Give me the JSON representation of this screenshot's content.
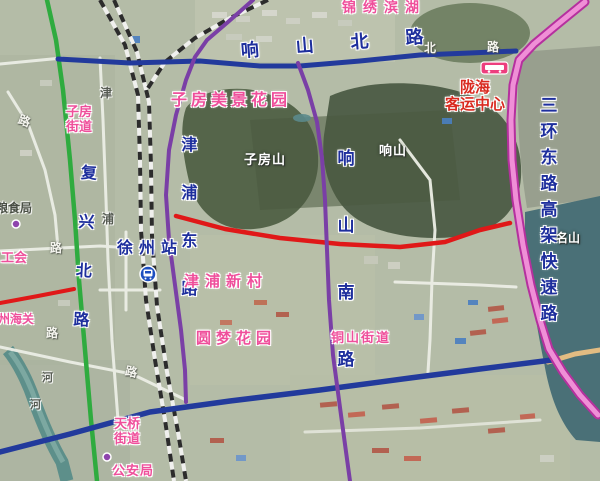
{
  "map": {
    "road_labels": {
      "xiangshan_north": "响山北路",
      "jinpu_east": "津浦东路",
      "xiangshan_south": "响山南路",
      "fuxing_north": "复兴北路",
      "third_ring_expressway": "三环东路高架快速路"
    },
    "stations": {
      "railway_station": "徐州站",
      "bus_terminal": "陇海\n客运中心"
    },
    "places": {
      "jinxiu_binhu": "锦绣滨湖",
      "zifang_scenic_garden": "子房美景花园",
      "zifang_subdistrict": "子房\n街道",
      "jinpu_xincun": "津浦新村",
      "yuanmeng_garden": "圆梦花园",
      "tongshan_subdistrict": "铜山街道",
      "tianqiao_subdistrict": "天桥\n街道",
      "public_security_bureau": "公安局",
      "labor_union": "工会",
      "customs": "州海关",
      "grain_bureau": "粮食局"
    },
    "mountains": {
      "zifangshan": "子房山",
      "xiangshan": "响山",
      "mingshan": "名山"
    },
    "fragments": {
      "jin": "津",
      "pu": "浦",
      "he1": "河",
      "he2": "河",
      "lu1": "路",
      "lu2": "路",
      "lu3": "路",
      "lu4": "路",
      "bei_w": "北",
      "lu_w": "路"
    },
    "icons": {
      "bus_badge": "bus-icon",
      "railway_station_badge": "train-station-icon",
      "poi_marker": "poi-dot-icon"
    },
    "colors": {
      "road_blue": "#223a9c",
      "road_red": "#e01818",
      "road_green": "#2fab3f",
      "road_purple": "#7a3fa6",
      "highway_magenta": "#b5309e",
      "label_pink": "#ef4f9b",
      "label_red": "#d92b20",
      "water": "#4a7077"
    }
  }
}
